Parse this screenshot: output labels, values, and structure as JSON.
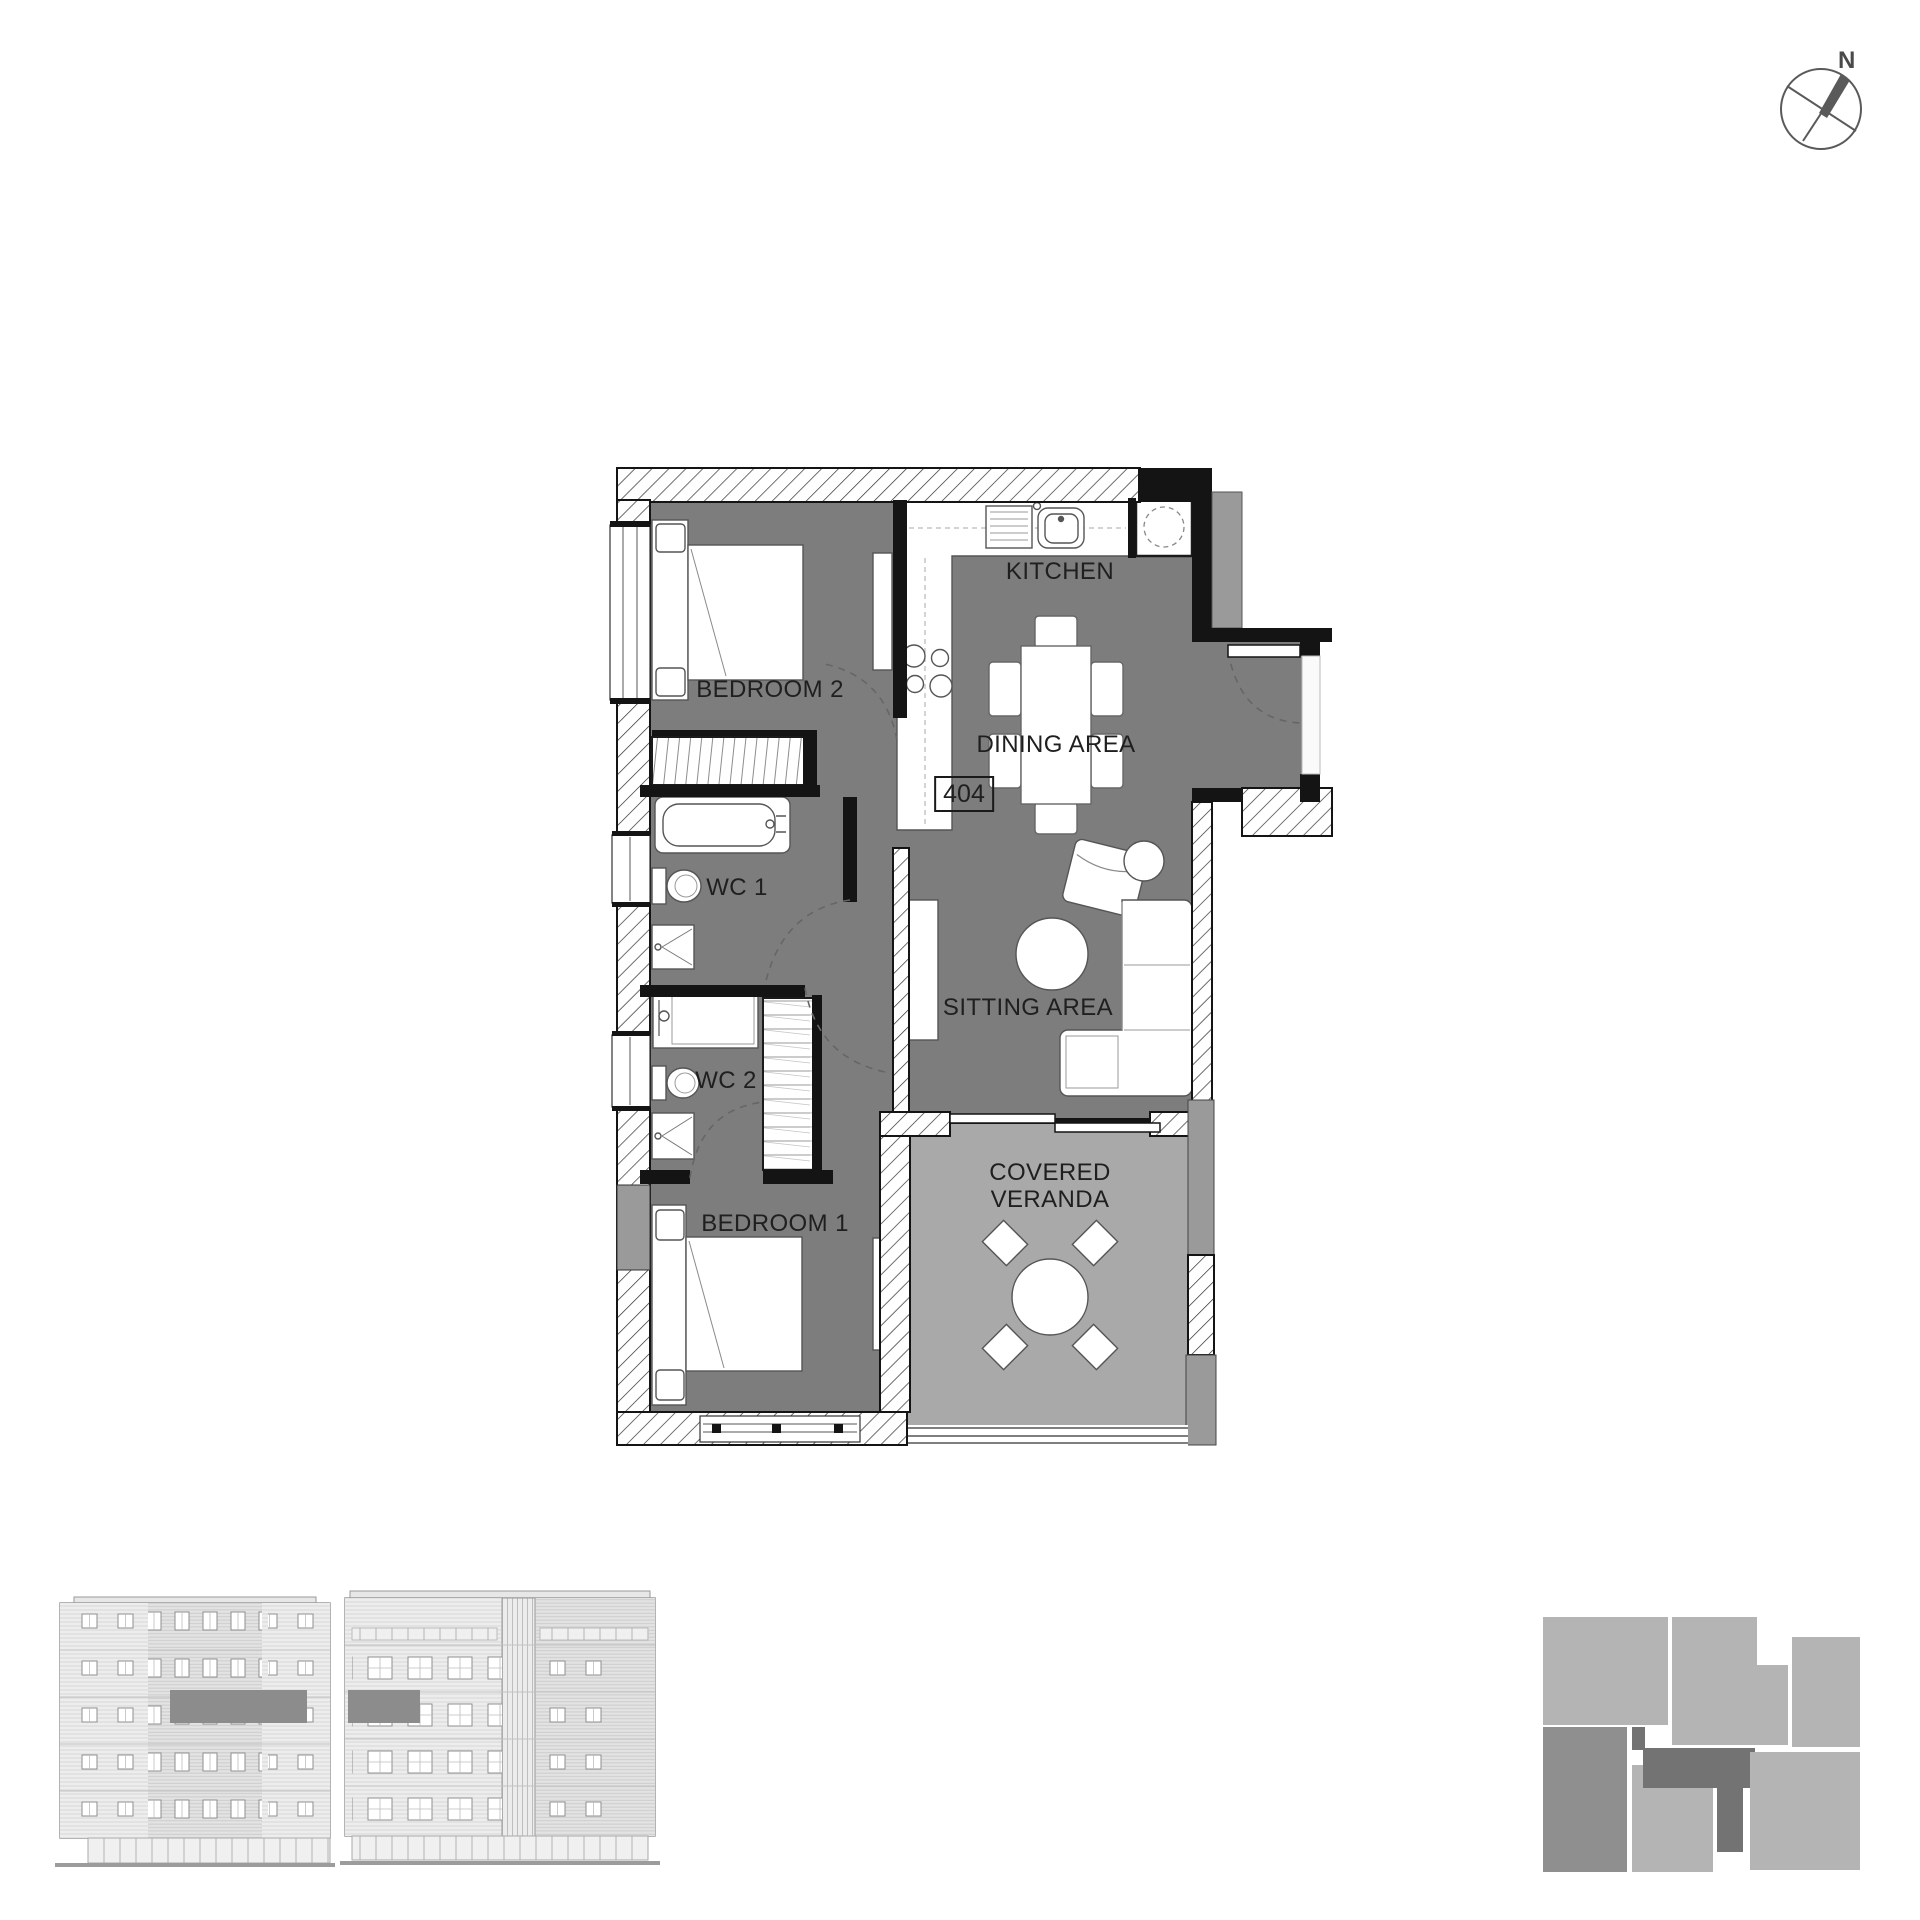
{
  "colors": {
    "floor_dark": "#7d7d7d",
    "floor_veranda": "#a9a9a9",
    "wall_black": "#141414",
    "wall_gray": "#9a9a9a",
    "line_gray": "#555555",
    "elevation_highlight": "#8c8c8c",
    "keyplan_light": "#b4b4b4",
    "keyplan_medium": "#8f8f8f",
    "keyplan_dark": "#737373",
    "label_color": "#1f1f1f"
  },
  "compass": {
    "label": "N"
  },
  "floor_plan": {
    "unit_number": "404",
    "rooms": {
      "kitchen": {
        "label": "KITCHEN"
      },
      "dining": {
        "label": "DINING AREA"
      },
      "bedroom2": {
        "label": "BEDROOM 2"
      },
      "wc1": {
        "label": "WC 1"
      },
      "wc2": {
        "label": "WC 2"
      },
      "bedroom1": {
        "label": "BEDROOM 1"
      },
      "sitting": {
        "label": "SITTING AREA"
      },
      "veranda": {
        "label_line1": "COVERED",
        "label_line2": "VERANDA"
      }
    }
  }
}
